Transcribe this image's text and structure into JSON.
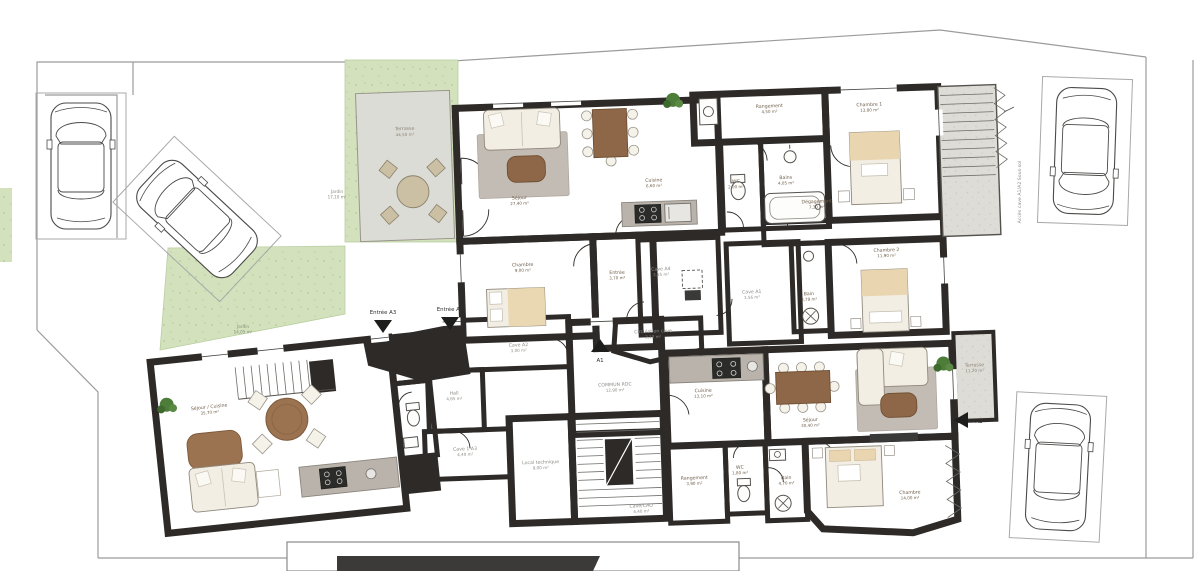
{
  "plan": {
    "type": "floor-plan",
    "floor": "rez-de-chaussée",
    "units_visible": [
      "A1",
      "A2",
      "A3",
      "A4"
    ]
  },
  "colors": {
    "wall": "#2d2a28",
    "wood_light": "#d7b98e",
    "wood_mid": "#cfa87c",
    "wood_dark": "#ad8a6c",
    "tile_beige": "#eae0d4",
    "garden_green": "#d3e2bd",
    "terrace_gray": "#dcdcd6",
    "boundary_gray": "#9b9b9b",
    "arrow_black": "#1d1d1b"
  },
  "labels": {
    "terrasse_top": {
      "name": "Terrasse",
      "area": "44,50 m²"
    },
    "jardin_left": {
      "name": "Jardin",
      "area": "17,10 m²"
    },
    "jardin_lower": {
      "name": "Jardin",
      "area": "14,05 m²"
    },
    "sejour_a3": {
      "name": "Séjour",
      "area": "27,40 m²"
    },
    "cuisine_a3": {
      "name": "Cuisine",
      "area": "6,60 m²"
    },
    "chambre_a3": {
      "name": "Chambre",
      "area": "9,00 m²"
    },
    "entree_a3_room": {
      "name": "Entrée",
      "area": "3,70 m²"
    },
    "wc_top": {
      "name": "WC",
      "area": "2,00 m²"
    },
    "bains_top": {
      "name": "Bains",
      "area": "4,05 m²"
    },
    "rangement_top": {
      "name": "Rangement",
      "area": "4,50 m²"
    },
    "chambre1": {
      "name": "Chambre 1",
      "area": "13,80 m²"
    },
    "degagement": {
      "name": "Dégagement",
      "area": "7,30 m²"
    },
    "chambre2": {
      "name": "Chambre 2",
      "area": "11,90 m²"
    },
    "bain_right": {
      "name": "Bain",
      "area": "3,79 m²"
    },
    "cave_a4": {
      "name": "Cave A4",
      "area": "3,55 m²"
    },
    "cave_a1_center": {
      "name": "Cave A1",
      "area": "3,56 m²"
    },
    "circulation_cave": {
      "name": "Circulation cave",
      "area": "2,10 m²"
    },
    "commun_rdc": {
      "name": "COMMUN RDC",
      "area": "12,90 m²"
    },
    "cave_a2": {
      "name": "Cave A2",
      "area": "3,00 m²"
    },
    "hall": {
      "name": "Hall",
      "area": "4,85 m²"
    },
    "sejour_cuisine_a1": {
      "name": "Séjour / Cuisine",
      "area": "35,70 m²"
    },
    "cave_1a3": {
      "name": "Cave 1-A3",
      "area": "4,40 m²"
    },
    "local_technique": {
      "name": "Local technique",
      "area": "9,00 m²"
    },
    "cave_cao": {
      "name": "Cave/CAO",
      "area": "4,40 m²"
    },
    "cuisine_a2": {
      "name": "Cuisine",
      "area": "13,10 m²"
    },
    "sejour_a2": {
      "name": "Séjour",
      "area": "30,40 m²"
    },
    "chambre_a2": {
      "name": "Chambre",
      "area": "14,00 m²"
    },
    "rangement_a2": {
      "name": "Rangement",
      "area": "3,90 m²"
    },
    "wc_a2": {
      "name": "WC",
      "area": "1,80 m²"
    },
    "bain_a2": {
      "name": "Bain",
      "area": "4,70 m²"
    },
    "terrasse_right": {
      "name": "Terrasse",
      "area": "11,20 m²"
    },
    "acces_cave": "Accès cave A1/A2 Sous-sol",
    "entree_a3": "Entrée A3",
    "entree_a1": "Entrée A1",
    "unit_a1": "A1",
    "unit_a2": "A2"
  }
}
